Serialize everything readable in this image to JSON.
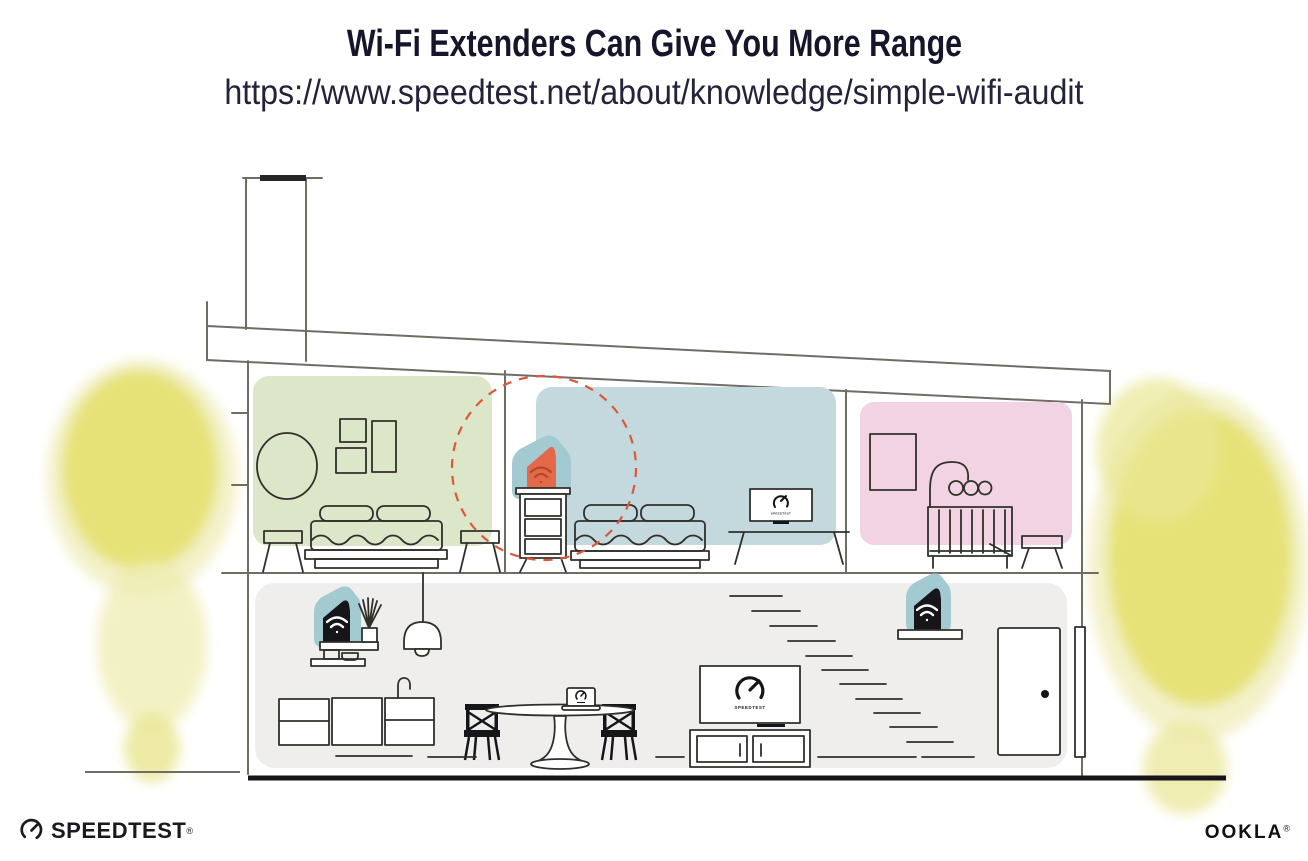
{
  "header": {
    "title": "Wi-Fi Extenders Can Give You More Range",
    "url": "https://www.speedtest.net/about/knowledge/simple-wifi-audit"
  },
  "scene": {
    "tv_label": "SPEEDTEST",
    "icons": {
      "speedtest_gauge": "gauge-with-needle",
      "wifi": "wifi-arcs-and-dot"
    },
    "colors": {
      "room_green": "#dce7c9",
      "room_blue": "#c4d9de",
      "room_pink": "#f2d3e3",
      "floor_gray": "#efeeec",
      "device_teal": "#a3c9d1",
      "extender_orange": "#e4684a",
      "extender_wifi": "#b04a26",
      "router_black": "#15151a",
      "coverage_red": "#e05638",
      "tree_yellow": "#e4e06e",
      "tree_yellow_halo": "#f0eebb"
    }
  },
  "footer": {
    "speedtest_label": "SPEEDTEST",
    "speedtest_reg": "®",
    "ookla_label": "OOKLA",
    "ookla_reg": "®"
  }
}
